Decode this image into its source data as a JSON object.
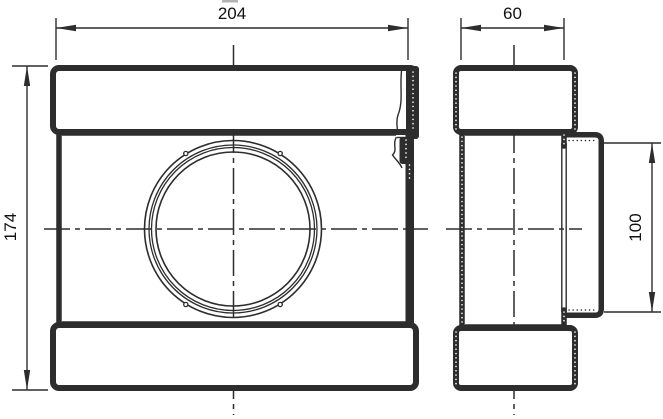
{
  "drawing": {
    "type": "technical-drawing",
    "subject": "flat-duct-tee-with-round-branch",
    "views": {
      "front": "front-view",
      "side": "side-view"
    },
    "dimensions": {
      "front_width": "204",
      "front_height": "174",
      "side_depth": "60",
      "branch_diameter": "100"
    },
    "colors": {
      "line": "#2d2d2d",
      "background": "#ffffff",
      "text": "#111111",
      "artifact": "#b3b3b3"
    }
  }
}
